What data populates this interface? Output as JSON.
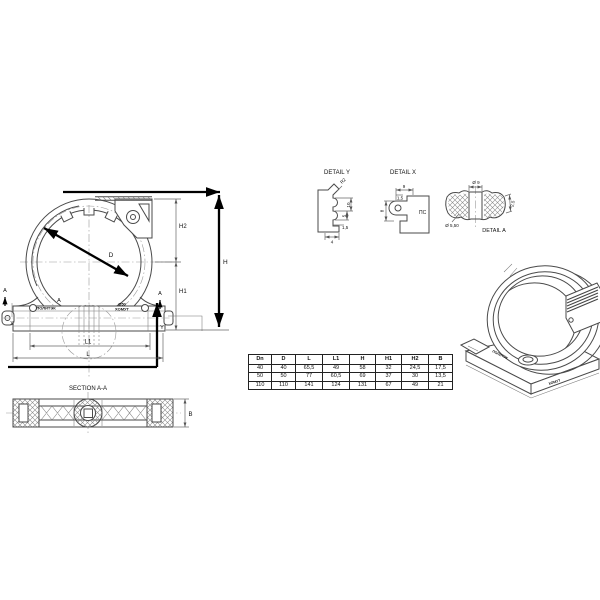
{
  "labels": {
    "d": "D",
    "h": "H",
    "h1": "H1",
    "h2": "H2",
    "l": "L",
    "l1": "L1",
    "a": "A",
    "x": "X",
    "y": "Y",
    "brand": "ПОЛИТЭК",
    "size": "Ø50",
    "product": "ХОМУТ"
  },
  "detail_y": {
    "title": "DETAIL Y",
    "r": "R2",
    "v1": "10",
    "v2": "5",
    "h1": "1,5",
    "h2": "4"
  },
  "detail_x": {
    "title": "DETAIL X",
    "w": "9",
    "w2": "1,5",
    "h": "8",
    "note": "ПС"
  },
  "detail_a": {
    "title": "DETAIL A",
    "d_top": "Ø 9",
    "d_hole": "Ø 5,50",
    "t": "2,5"
  },
  "section": {
    "title": "SECTION A-A",
    "b": "B"
  },
  "table": {
    "headers": [
      "Dn",
      "D",
      "L",
      "L1",
      "H",
      "H1",
      "H2",
      "B"
    ],
    "rows": [
      [
        "40",
        "40",
        "65,5",
        "49",
        "58",
        "32",
        "24,5",
        "17,5"
      ],
      [
        "50",
        "50",
        "77",
        "60,5",
        "69",
        "37",
        "30",
        "13,5"
      ],
      [
        "110",
        "110",
        "141",
        "124",
        "131",
        "67",
        "49",
        "21"
      ]
    ]
  },
  "colors": {
    "line": "#4a4a4a",
    "bold": "#000000",
    "centerline": "#999999"
  }
}
